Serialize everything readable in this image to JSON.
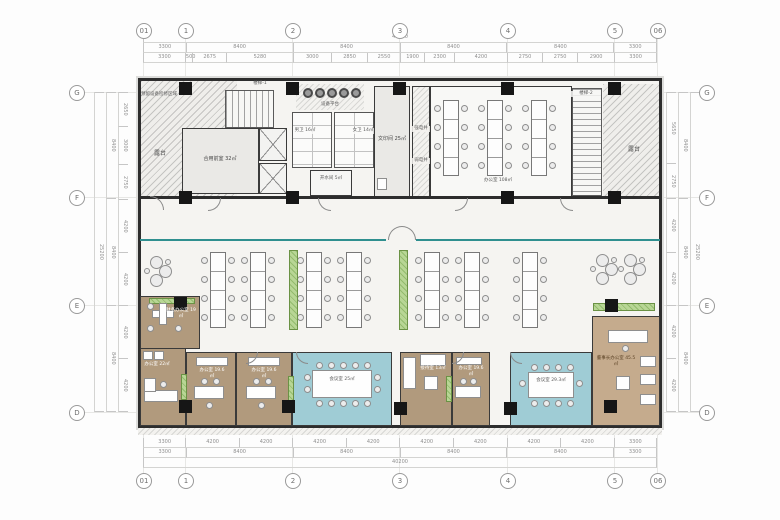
{
  "colors": {
    "wall": "#2d2d2d",
    "floor": "#f5f4f1",
    "wood_floor": "#b19a7d",
    "wood_light": "#c5ab8d",
    "meeting_blue": "#9fccd5",
    "cabinet_green": "#a8cc80",
    "glass_teal": "#2f8f8f"
  },
  "grid": {
    "top": [
      "01",
      "1",
      "2",
      "3",
      "4",
      "5",
      "06"
    ],
    "bottom": [
      "01",
      "1",
      "2",
      "3",
      "4",
      "5",
      "06"
    ],
    "left": [
      "G",
      "F",
      "E",
      "D"
    ],
    "right": [
      "G",
      "F",
      "E",
      "D"
    ]
  },
  "dims": {
    "top_total": "40200",
    "top_row1": [
      "3300",
      "8400",
      "8400",
      "8400",
      "8400",
      "3300"
    ],
    "top_row2": [
      "3300",
      "500",
      "2675",
      "5280",
      "3000",
      "2850",
      "2550",
      "1900",
      "2300",
      "4200",
      "2750",
      "2750",
      "2900",
      "3300"
    ],
    "bottom_row1": [
      "3300",
      "4200",
      "4200",
      "4200",
      "4200",
      "4200",
      "4200",
      "4200",
      "4200",
      "3300"
    ],
    "bottom_row2": [
      "3300",
      "8400",
      "8400",
      "8400",
      "8400",
      "3300"
    ],
    "bottom_total": "40200",
    "left_sub": [
      "2650",
      "3000",
      "2750",
      "4200",
      "4200",
      "4200",
      "4200"
    ],
    "left_coarse": [
      "8400",
      "8400",
      "8400"
    ],
    "left_total": "25200",
    "right_sub": [
      "5650",
      "2750",
      "4200",
      "4200",
      "4200",
      "4200"
    ],
    "right_coarse": [
      "8400",
      "8400",
      "8400"
    ],
    "right_total": "25200"
  },
  "rooms": {
    "terrace_left": "露台",
    "equip_zone": "预留设备检修区域",
    "stair1": "楼梯-1",
    "vestibule": "合用前室 32㎡",
    "equip_platform": "设备平台",
    "mens": "男卫 16㎡",
    "womens": "女卫 14㎡",
    "water": "开水间 5㎡",
    "print": "文印间 25㎡",
    "shaft_strong": "强电井",
    "shaft_weak": "弱电井",
    "office_top": "办公室 108㎡",
    "stair2": "楼梯-2",
    "terrace_right": "露台",
    "finance": "财务办公室 19㎡",
    "office_22": "办公室 22㎡",
    "office_196a": "办公室 19.6㎡",
    "office_196b": "办公室 19.6㎡",
    "meeting_25": "会议室 25㎡",
    "reception": "接待室 13㎡",
    "office_196c": "办公室 19.6㎡",
    "meeting_293": "会议室 29.3㎡",
    "chairman": "董事长办公室 45.5㎡"
  }
}
